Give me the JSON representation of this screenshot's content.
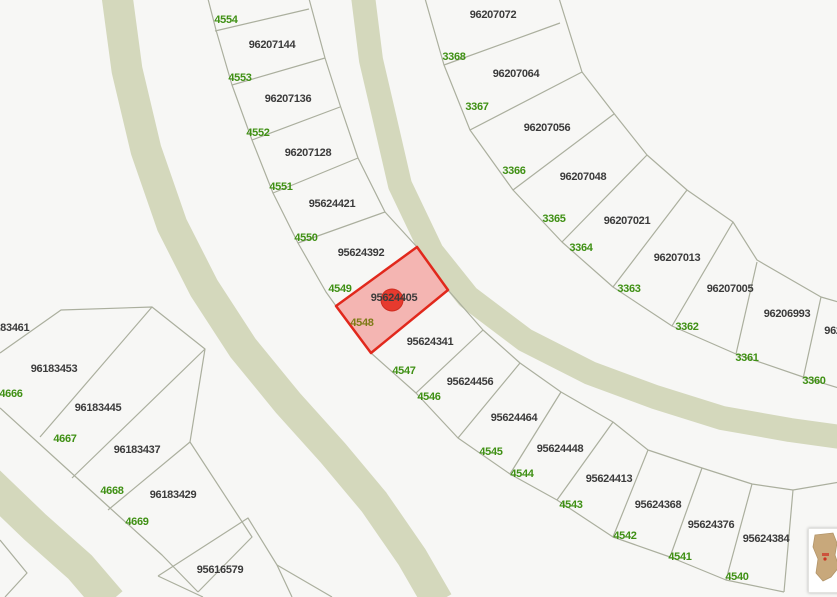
{
  "map": {
    "colors": {
      "background": "#f7f7f5",
      "road": "#d4d8bc",
      "parcel_line": "#abaf9e",
      "parcel_label": "#3b3b3b",
      "address_label": "#3f9014",
      "address_label_on_highlight": "#7e7a16",
      "highlight_fill": "#f4b5b2",
      "highlight_stroke": "#e1281c",
      "marker": "#e63a2e",
      "thumbnail_blob": "#c8a87b"
    },
    "selected_parcel": {
      "id": "95624405",
      "polygon": "417,247 448,290 371,353 336,306",
      "marker": {
        "x": 392,
        "y": 300,
        "r": 11
      }
    },
    "parcel_labels": [
      {
        "text": "96207144",
        "x": 272,
        "y": 45
      },
      {
        "text": "96207136",
        "x": 288,
        "y": 99
      },
      {
        "text": "96207128",
        "x": 308,
        "y": 153
      },
      {
        "text": "95624421",
        "x": 332,
        "y": 204
      },
      {
        "text": "95624392",
        "x": 361,
        "y": 253
      },
      {
        "text": "95624405",
        "x": 394,
        "y": 298
      },
      {
        "text": "95624341",
        "x": 430,
        "y": 342
      },
      {
        "text": "95624456",
        "x": 470,
        "y": 382
      },
      {
        "text": "95624464",
        "x": 514,
        "y": 418
      },
      {
        "text": "95624448",
        "x": 560,
        "y": 449
      },
      {
        "text": "95624413",
        "x": 609,
        "y": 479
      },
      {
        "text": "95624368",
        "x": 658,
        "y": 505
      },
      {
        "text": "95624376",
        "x": 711,
        "y": 525
      },
      {
        "text": "95624384",
        "x": 766,
        "y": 539
      },
      {
        "text": "96207072",
        "x": 493,
        "y": 15
      },
      {
        "text": "96207064",
        "x": 516,
        "y": 74
      },
      {
        "text": "96207056",
        "x": 547,
        "y": 128
      },
      {
        "text": "96207048",
        "x": 583,
        "y": 177
      },
      {
        "text": "96207021",
        "x": 627,
        "y": 221
      },
      {
        "text": "96207013",
        "x": 677,
        "y": 258
      },
      {
        "text": "96207005",
        "x": 730,
        "y": 289
      },
      {
        "text": "96206993",
        "x": 787,
        "y": 314
      },
      {
        "text": "962",
        "x": 833,
        "y": 331
      },
      {
        "text": "96183461",
        "x": 6,
        "y": 328
      },
      {
        "text": "96183453",
        "x": 54,
        "y": 369
      },
      {
        "text": "96183445",
        "x": 98,
        "y": 408
      },
      {
        "text": "96183437",
        "x": 137,
        "y": 450
      },
      {
        "text": "96183429",
        "x": 173,
        "y": 495
      },
      {
        "text": "95616579",
        "x": 220,
        "y": 570
      }
    ],
    "address_labels": [
      {
        "text": "4554",
        "x": 226,
        "y": 20
      },
      {
        "text": "4553",
        "x": 240,
        "y": 78
      },
      {
        "text": "4552",
        "x": 258,
        "y": 133
      },
      {
        "text": "4551",
        "x": 281,
        "y": 187
      },
      {
        "text": "4550",
        "x": 306,
        "y": 238
      },
      {
        "text": "4549",
        "x": 340,
        "y": 289
      },
      {
        "text": "4548",
        "x": 362,
        "y": 323,
        "on_highlight": true
      },
      {
        "text": "4547",
        "x": 404,
        "y": 371
      },
      {
        "text": "4546",
        "x": 429,
        "y": 397
      },
      {
        "text": "4545",
        "x": 491,
        "y": 452
      },
      {
        "text": "4544",
        "x": 522,
        "y": 474
      },
      {
        "text": "4543",
        "x": 571,
        "y": 505
      },
      {
        "text": "4542",
        "x": 625,
        "y": 536
      },
      {
        "text": "4541",
        "x": 680,
        "y": 557
      },
      {
        "text": "4540",
        "x": 737,
        "y": 577
      },
      {
        "text": "3368",
        "x": 454,
        "y": 57
      },
      {
        "text": "3367",
        "x": 477,
        "y": 107
      },
      {
        "text": "3366",
        "x": 514,
        "y": 171
      },
      {
        "text": "3365",
        "x": 554,
        "y": 219
      },
      {
        "text": "3364",
        "x": 581,
        "y": 248
      },
      {
        "text": "3363",
        "x": 629,
        "y": 289
      },
      {
        "text": "3362",
        "x": 687,
        "y": 327
      },
      {
        "text": "3361",
        "x": 747,
        "y": 358
      },
      {
        "text": "3360",
        "x": 814,
        "y": 381
      },
      {
        "text": "4666",
        "x": 11,
        "y": 394
      },
      {
        "text": "4667",
        "x": 65,
        "y": 439
      },
      {
        "text": "4668",
        "x": 112,
        "y": 491
      },
      {
        "text": "4669",
        "x": 137,
        "y": 522
      }
    ]
  },
  "thumbnail": {
    "x": 808,
    "y": 528,
    "width": 33,
    "height": 63
  }
}
